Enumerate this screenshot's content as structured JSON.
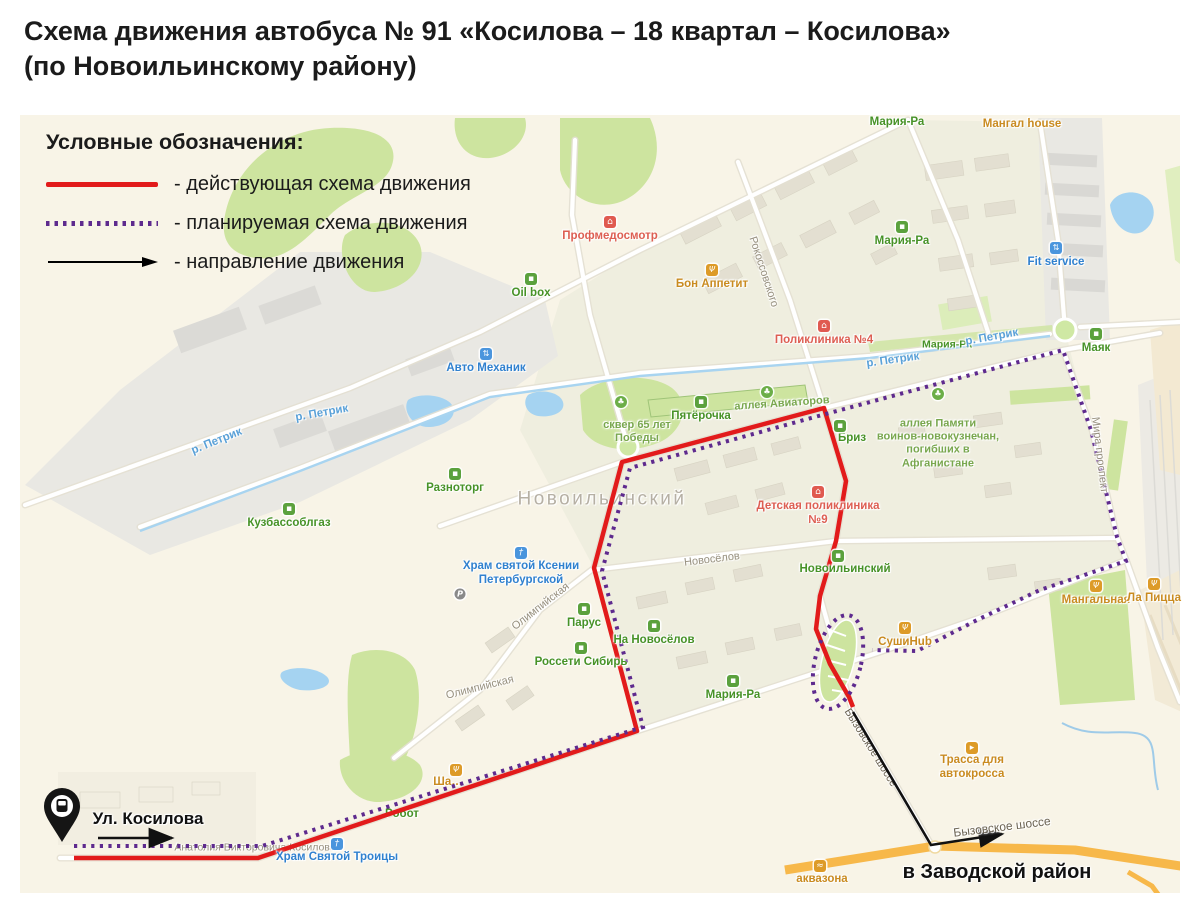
{
  "title": {
    "line1": "Схема движения автобуса № 91 «Косилова – 18 квартал – Косилова»",
    "line2": "(по Новоильинскому району)"
  },
  "legend": {
    "heading": "Условные обозначения:",
    "items": [
      {
        "label": "- действующая схема движения",
        "style": "solid-red-line",
        "color": "#e21b1b"
      },
      {
        "label": "- планируемая схема движения",
        "style": "dotted-purple-line",
        "color": "#5e2a8e"
      },
      {
        "label": "- направление движения",
        "style": "black-arrow",
        "color": "#000000"
      }
    ]
  },
  "map": {
    "colors": {
      "current_route": "#e21b1b",
      "planned_route": "#5e2a8e",
      "direction_arrow": "#000000",
      "highway": "#f7b84a",
      "water": "#a5d3f1",
      "park": "#cde49f",
      "background": "#f8f4e7"
    },
    "stop_marker": {
      "label": "Ул. Косилова",
      "icon": "bus-pin-icon"
    },
    "labels": [
      {
        "text": "Мария-Ра",
        "category": "shop"
      },
      {
        "text": "Мангал house",
        "category": "food"
      },
      {
        "text": "Профмедосмотр",
        "category": "medical"
      },
      {
        "text": "Бон Аппетит",
        "category": "food"
      },
      {
        "text": "Рокоссовского",
        "category": "street"
      },
      {
        "text": "Мария-Ра",
        "category": "shop"
      },
      {
        "text": "Fit service",
        "category": "service"
      },
      {
        "text": "Oil box",
        "category": "shop"
      },
      {
        "text": "Авто Механик",
        "category": "service"
      },
      {
        "text": "р. Петрик",
        "category": "water"
      },
      {
        "text": "р. Петрик",
        "category": "water"
      },
      {
        "text": "Разноторг",
        "category": "shop"
      },
      {
        "text": "Кузбассоблгаз",
        "category": "shop"
      },
      {
        "text": "сквер 65 лет\nПобеды",
        "category": "park"
      },
      {
        "text": "Пятёрочка",
        "category": "shop"
      },
      {
        "text": "аллея Авиаторов",
        "category": "park"
      },
      {
        "text": "Поликлиника №4",
        "category": "medical"
      },
      {
        "text": "р. Петрик",
        "category": "water"
      },
      {
        "text": "Мария-Ра",
        "category": "shop"
      },
      {
        "text": "р. Петрик",
        "category": "water"
      },
      {
        "text": "Маяк",
        "category": "shop"
      },
      {
        "text": "Бриз",
        "category": "shop"
      },
      {
        "text": "аллея Памяти\nвоинов-новокузнечан,\nпогибших в\nАфганистане",
        "category": "park"
      },
      {
        "text": "Новоильинский",
        "category": "district"
      },
      {
        "text": "Детская поликлиника\n№9",
        "category": "medical"
      },
      {
        "text": "Храм святой Ксении\nПетербургской",
        "category": "church"
      },
      {
        "text": "Новосёлов",
        "category": "street"
      },
      {
        "text": "Новоильинский",
        "category": "shop"
      },
      {
        "text": "Олимпийская",
        "category": "street"
      },
      {
        "text": "Парус",
        "category": "shop"
      },
      {
        "text": "На Новосёлов",
        "category": "shop"
      },
      {
        "text": "Россети Сибирь",
        "category": "shop"
      },
      {
        "text": "Мария-Ра",
        "category": "shop"
      },
      {
        "text": "Олимпийская",
        "category": "street"
      },
      {
        "text": "Мангальная",
        "category": "food"
      },
      {
        "text": "Ла Пицца",
        "category": "food"
      },
      {
        "text": "СушиHub",
        "category": "food"
      },
      {
        "text": "Мира проспект",
        "category": "street"
      },
      {
        "text": "Бызовское шоссе",
        "category": "street"
      },
      {
        "text": "Трасса для\nавтокросса",
        "category": "landmark"
      },
      {
        "text": "Бызовское шоссе",
        "category": "road"
      },
      {
        "text": "в Заводской район",
        "category": "direction-note"
      },
      {
        "text": "аквазона",
        "category": "landmark"
      },
      {
        "text": "Храм Святой Троицы",
        "category": "church"
      },
      {
        "text": "Ул. Косилова",
        "category": "stop"
      },
      {
        "text": "Анатолия Викторовича Косилова",
        "category": "street"
      },
      {
        "text": "Робот",
        "category": "shop"
      },
      {
        "text": "Ша…",
        "category": "food"
      }
    ]
  }
}
